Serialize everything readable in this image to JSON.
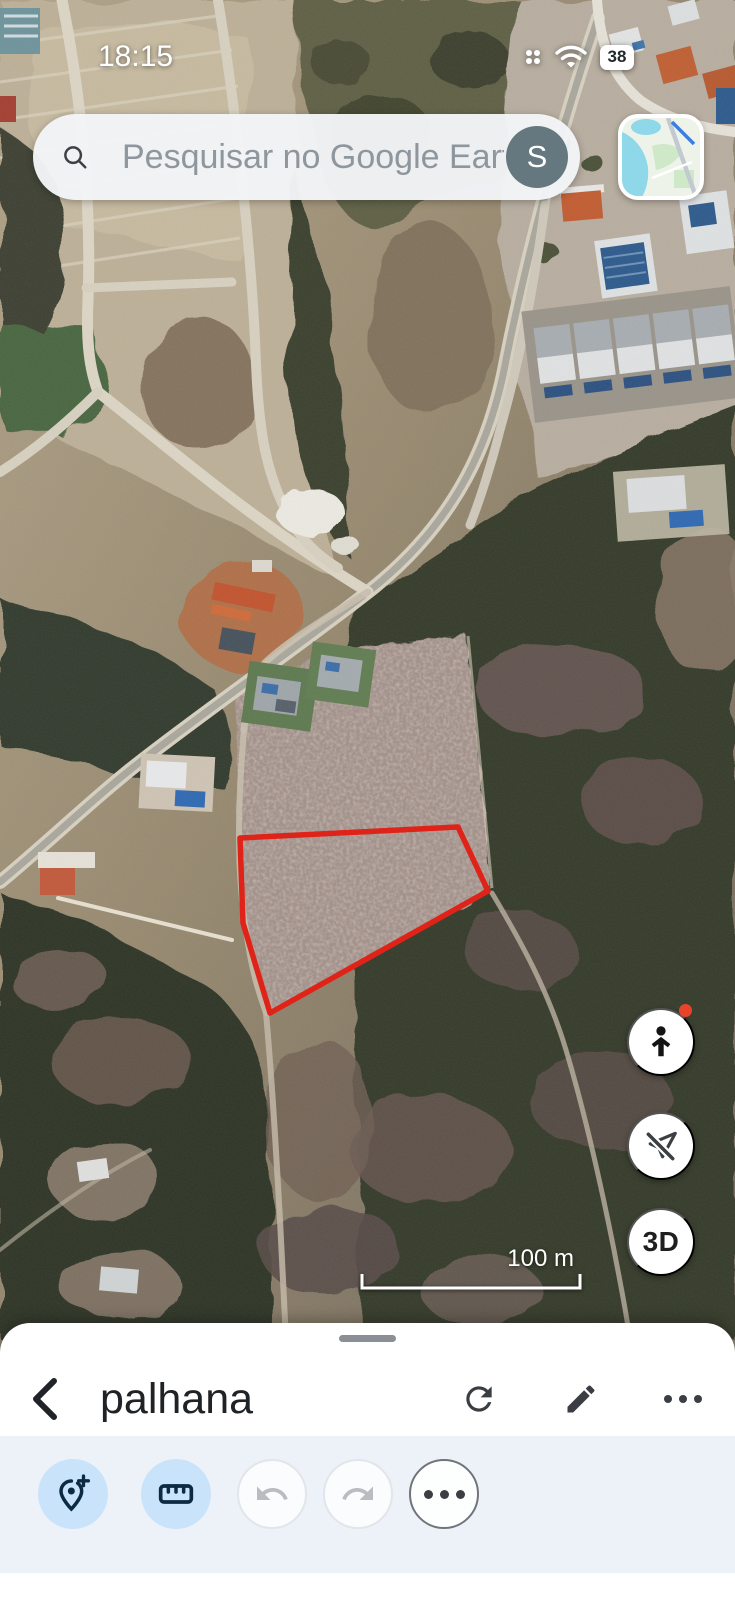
{
  "status_bar": {
    "time": "18:15",
    "battery_level": "38"
  },
  "search_bar": {
    "placeholder": "Pesquisar no Google Earth",
    "avatar_letter": "S"
  },
  "map_view": {
    "threed_button_label": "3D",
    "scale_bar_label": "100 m"
  },
  "bottom_sheet": {
    "title": "palhana"
  },
  "icons": {
    "search": "magnifier",
    "status_grid": "app-grid-dots",
    "wifi": "wifi-arcs",
    "battery": "battery-pill",
    "pegman": "person-silhouette",
    "flight_disabled": "paper-plane-crossed",
    "back": "chevron-left",
    "refresh": "reload-arrow",
    "edit": "pencil",
    "more": "ellipsis",
    "add_placemark": "map-pin-plus",
    "measure": "ruler",
    "undo": "undo-arrow",
    "redo": "redo-arrow",
    "more_tools": "ellipsis-circle"
  },
  "colors": {
    "parcel_outline_red": "#e02318",
    "notification_dot_red": "#e8442c",
    "toolbar_active_button_bg": "#c9e4fa",
    "toolbar_icon_navy": "#0c2a42",
    "toolbar_band_bg": "#edf1f8",
    "avatar_bg": "#66787f"
  }
}
